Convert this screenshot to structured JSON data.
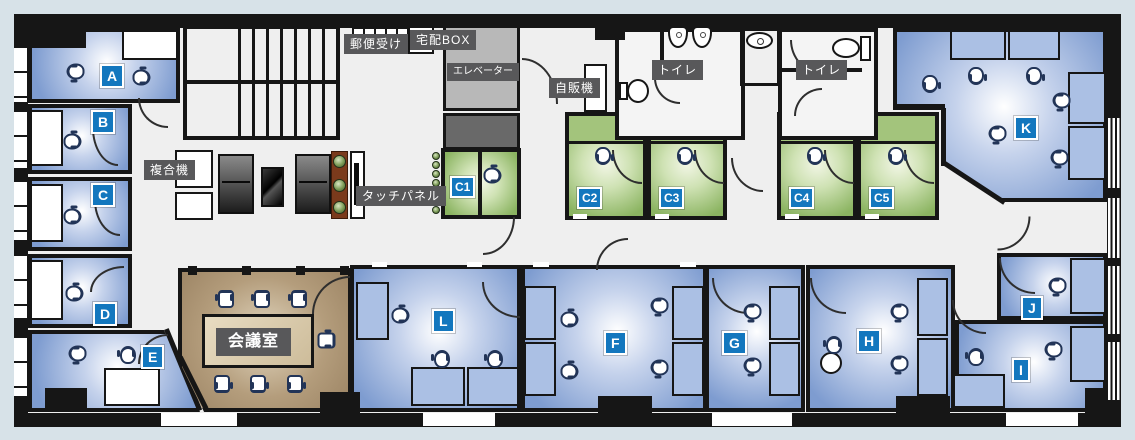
{
  "title": "Office floor plan",
  "colors": {
    "background": "#d7e2e8",
    "wall": "#161616",
    "floor": "#efefef",
    "room_blue": "#7e9cd0",
    "room_blue_light": "#c6d3ec",
    "room_green": "#8bb461",
    "room_green_light": "#cfe2b4",
    "meeting_brown": "#9c8464",
    "meeting_brown_light": "#e2d7c0",
    "label_gray": "#58585a",
    "chip_blue": "#1377be",
    "elevator_gray": "#b8b8b8",
    "service_gray": "#696969",
    "desk_blue": "#abc0e4",
    "chair_outline": "#223457"
  },
  "rooms": {
    "A": {
      "label": "A"
    },
    "B": {
      "label": "B"
    },
    "C": {
      "label": "C"
    },
    "D": {
      "label": "D"
    },
    "E": {
      "label": "E"
    },
    "F": {
      "label": "F"
    },
    "G": {
      "label": "G"
    },
    "H": {
      "label": "H"
    },
    "I": {
      "label": "I"
    },
    "J": {
      "label": "J"
    },
    "K": {
      "label": "K"
    },
    "L": {
      "label": "L"
    },
    "C1": {
      "label": "C1"
    },
    "C2": {
      "label": "C2"
    },
    "C3": {
      "label": "C3"
    },
    "C4": {
      "label": "C4"
    },
    "C5": {
      "label": "C5"
    }
  },
  "facilities": {
    "mailbox": "郵便受け",
    "delivery_box": "宅配BOX",
    "elevator": "エレベーター",
    "vending_machine": "自販機",
    "toilet_left": "トイレ",
    "toilet_right": "トイレ",
    "copier": "複合機",
    "touch_panel": "タッチパネル",
    "meeting_room": "会議室"
  }
}
